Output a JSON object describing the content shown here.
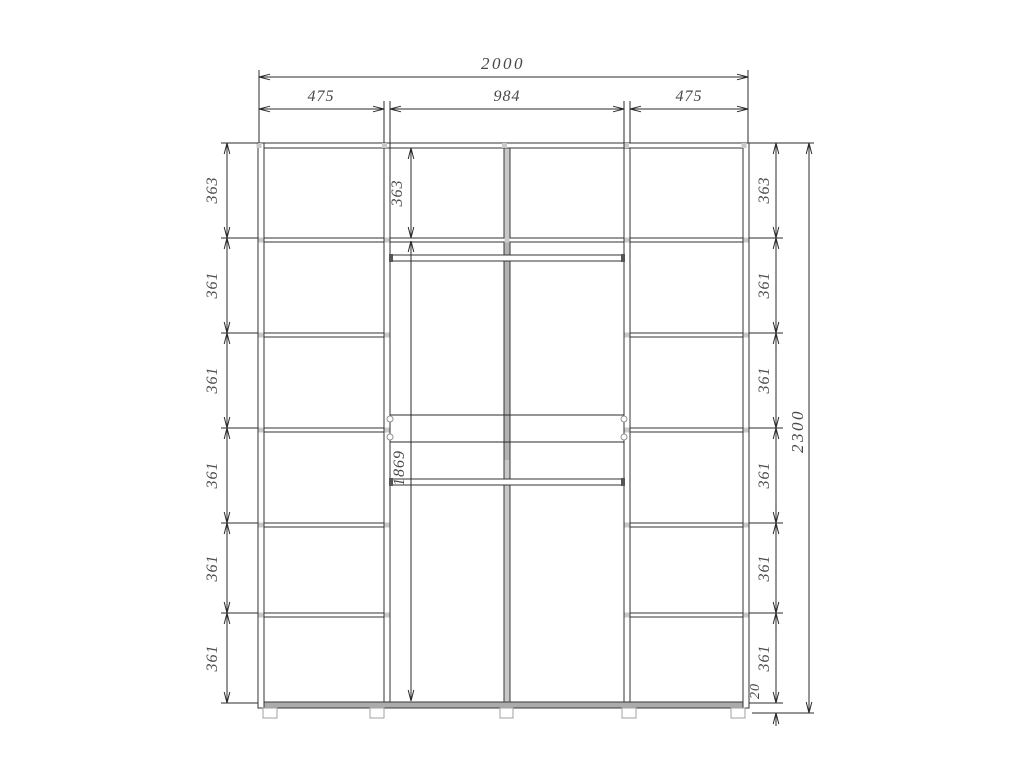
{
  "dimensions": {
    "overall_width": "2000",
    "top_segments": [
      "475",
      "984",
      "475"
    ],
    "left_column": [
      "363",
      "361",
      "361",
      "361",
      "361",
      "361"
    ],
    "middle_column": {
      "top": "363",
      "body": "1869"
    },
    "right_column": [
      "363",
      "361",
      "361",
      "361",
      "361",
      "361"
    ],
    "overall_height": "2300",
    "plinth_height": "20"
  }
}
